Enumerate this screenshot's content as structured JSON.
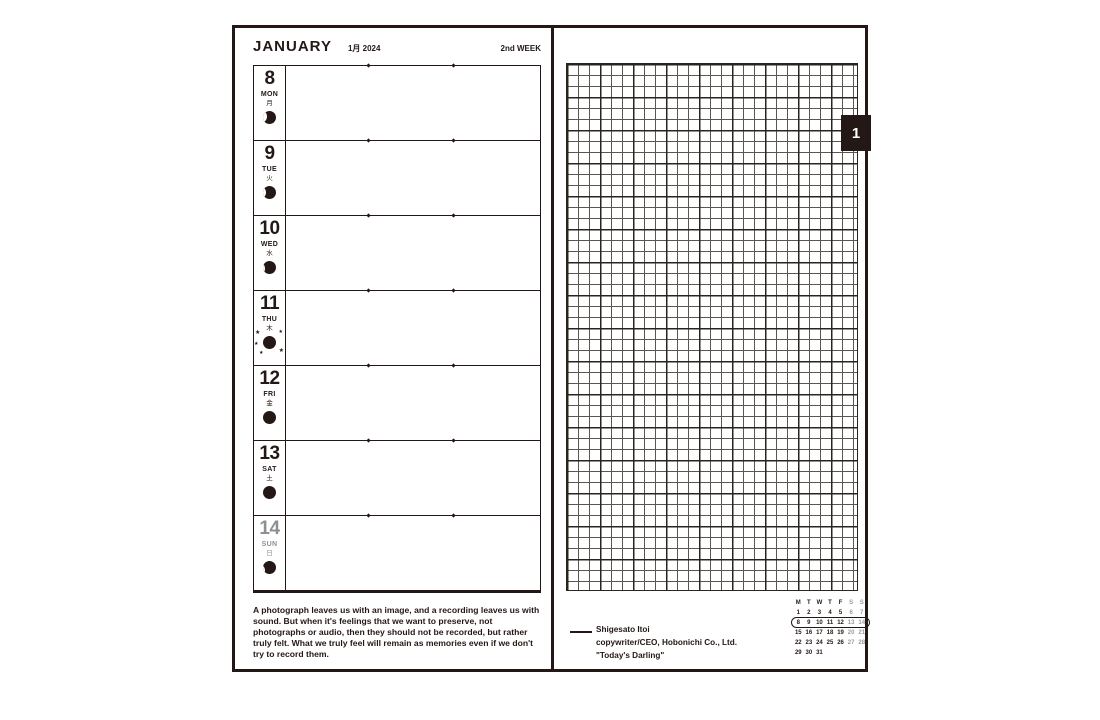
{
  "colors": {
    "ink": "#231815",
    "gray": "#8d9093",
    "paper": "#ffffff"
  },
  "icons": {
    "sparkle": "★",
    "moon_phase": "moon-phase-icon"
  },
  "left_page": {
    "month": "JANUARY",
    "date_label": "1月 2024",
    "week_label": "2nd WEEK",
    "days": [
      {
        "num": "8",
        "abbr": "MON",
        "kanji": "月",
        "moon": "waning-1",
        "tone": ""
      },
      {
        "num": "9",
        "abbr": "TUE",
        "kanji": "火",
        "moon": "waning-2",
        "tone": ""
      },
      {
        "num": "10",
        "abbr": "WED",
        "kanji": "水",
        "moon": "waning-3",
        "tone": ""
      },
      {
        "num": "11",
        "abbr": "THU",
        "kanji": "木",
        "moon": "new-sparkle",
        "tone": ""
      },
      {
        "num": "12",
        "abbr": "FRI",
        "kanji": "金",
        "moon": "dark",
        "tone": ""
      },
      {
        "num": "13",
        "abbr": "SAT",
        "kanji": "土",
        "moon": "dark",
        "tone": ""
      },
      {
        "num": "14",
        "abbr": "SUN",
        "kanji": "日",
        "moon": "waxing-1",
        "tone": "gray"
      }
    ],
    "quote": "A photograph leaves us with an image, and a recording leaves us with sound. But when it's feelings that we want to preserve, not photographs or audio, then they should not be recorded, but rather truly felt. What we truly feel will remain as memories even if we don't try to record them."
  },
  "right_page": {
    "tab_label": "1",
    "attribution": {
      "name": "Shigesato Itoi",
      "title": "copywriter/CEO, Hobonichi Co., Ltd.",
      "work": "\"Today's Darling\""
    },
    "mini_calendar": {
      "header": [
        "M",
        "T",
        "W",
        "T",
        "F",
        "S",
        "S"
      ],
      "weeks": [
        [
          "1",
          "2",
          "3",
          "4",
          "5",
          "6",
          "7"
        ],
        [
          "8",
          "9",
          "10",
          "11",
          "12",
          "13",
          "14"
        ],
        [
          "15",
          "16",
          "17",
          "18",
          "19",
          "20",
          "21"
        ],
        [
          "22",
          "23",
          "24",
          "25",
          "26",
          "27",
          "28"
        ],
        [
          "29",
          "30",
          "31",
          "",
          "",
          "",
          ""
        ]
      ],
      "highlighted_week": 1,
      "gray_columns": [
        5,
        6
      ]
    }
  }
}
